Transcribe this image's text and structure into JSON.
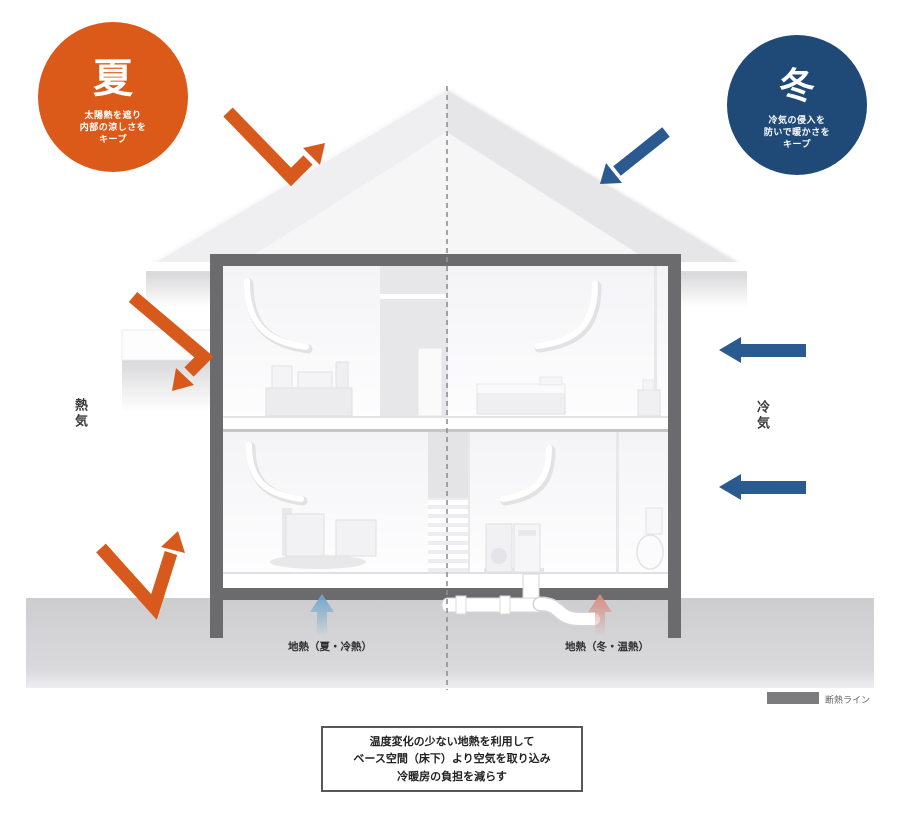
{
  "badges": {
    "summer": {
      "title": "夏",
      "lines": [
        "太陽熱を遮り",
        "内部の涼しさを",
        "キープ"
      ]
    },
    "winter": {
      "title": "冬",
      "lines": [
        "冷気の侵入を",
        "防いで暖かさを",
        "キープ"
      ]
    }
  },
  "side_labels": {
    "left": "熱気",
    "right": "冷気"
  },
  "ground_labels": {
    "left": "地熱（夏・冷熱）",
    "right": "地熱（冬・温熱）"
  },
  "legend": {
    "label": "断熱ライン"
  },
  "caption": {
    "lines": [
      "温度変化の少ない地熱を利用して",
      "ベース空間（床下）より空気を取り込み",
      "冷暖房の負担を減らす"
    ]
  },
  "colors": {
    "summer_orange": "#DB5A1A",
    "winter_navy": "#1F4A78",
    "arrow_blue": "#2B5A90",
    "cool_air_arrow": "#6FA8CE",
    "warm_air_arrow": "#D98C82",
    "insulation_wall": "#6B6B6D",
    "ground": "#D2D2D4",
    "insulation_swatch": "#7C7C7E"
  }
}
